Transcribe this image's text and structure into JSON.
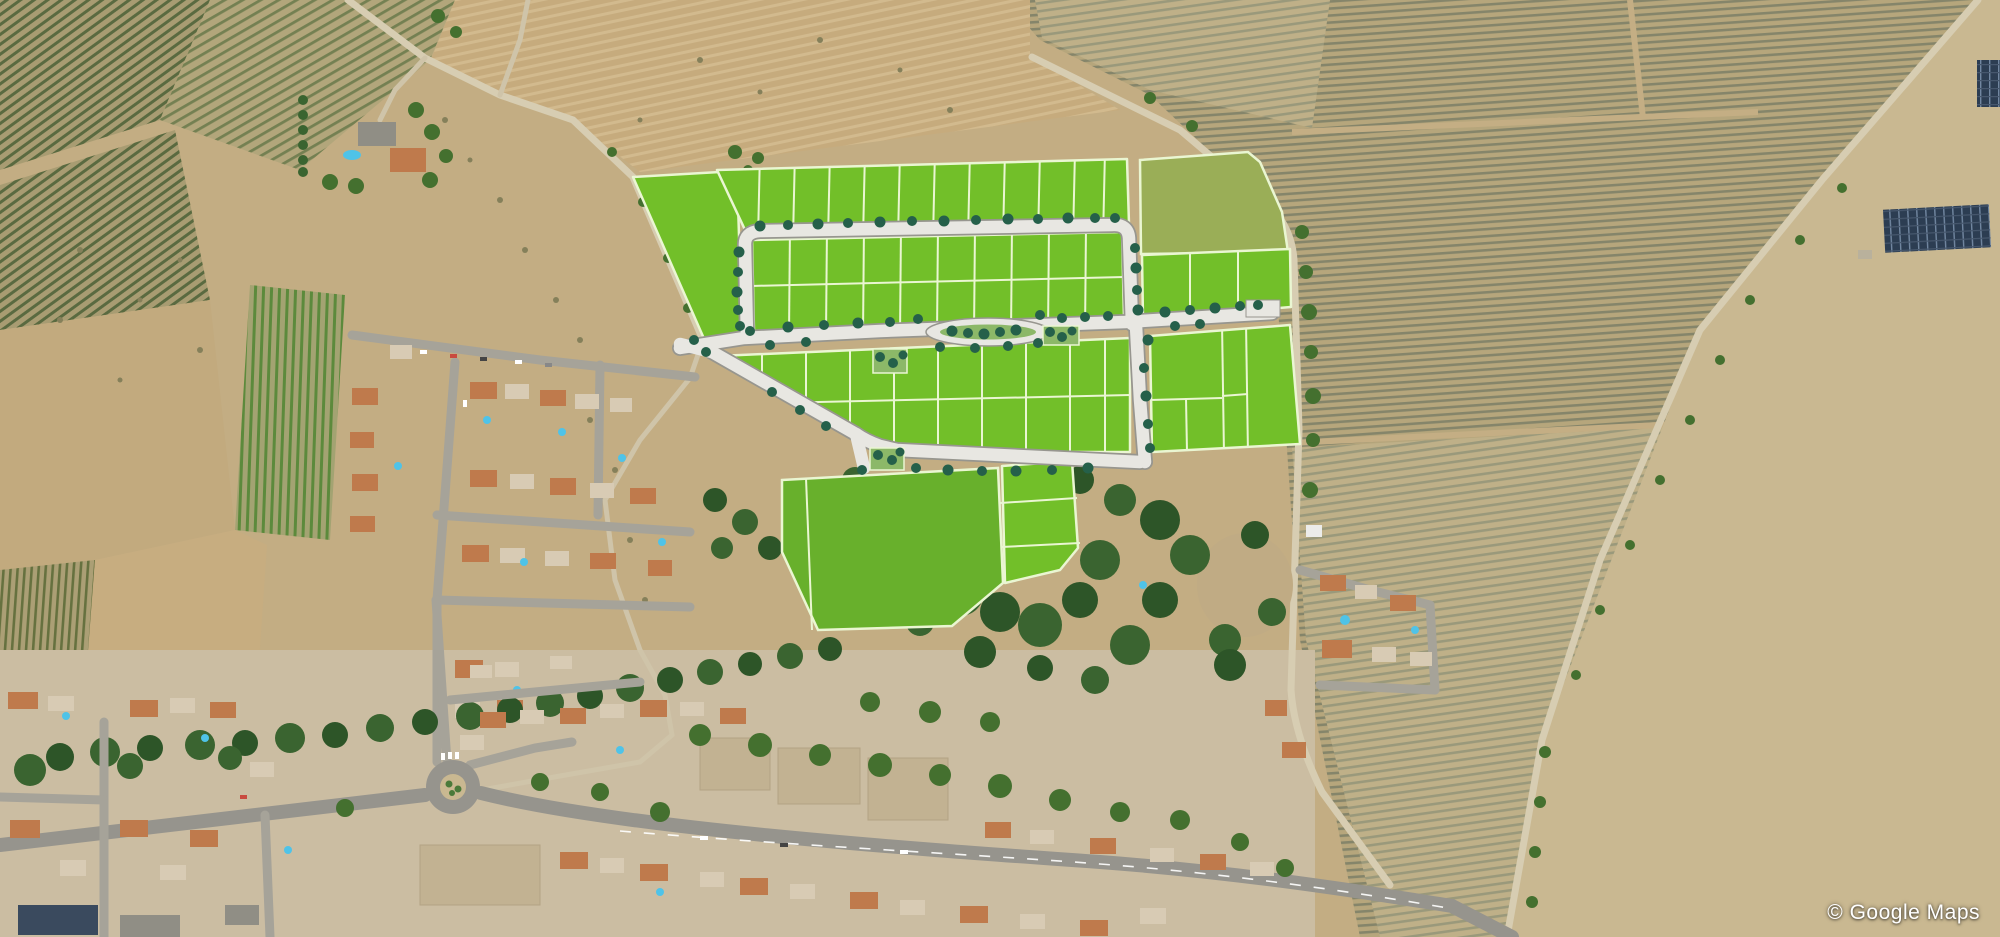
{
  "attribution": {
    "text": "© Google Maps"
  },
  "overlay": {
    "plot_fill": "#72bf29",
    "plot_border": "#eaf6d2",
    "olive_plot_fill": "#9aae57",
    "reserve_plot_fill": "#68b02c",
    "road_fill": "#e8e7e2",
    "road_edge": "#97968f",
    "street_tree_color": "#25604a",
    "median_fill": "#8cb868"
  },
  "terrain": {
    "base": "#c3ad83",
    "village_ground": "#cbbda2",
    "woodland": "#3a6430",
    "asphalt": "#96948d",
    "pool_color": "#4fc3e8",
    "roof_terracotta": "#bf7a4c",
    "roof_pale": "#d8cbb4",
    "roof_gray": "#908e85"
  }
}
